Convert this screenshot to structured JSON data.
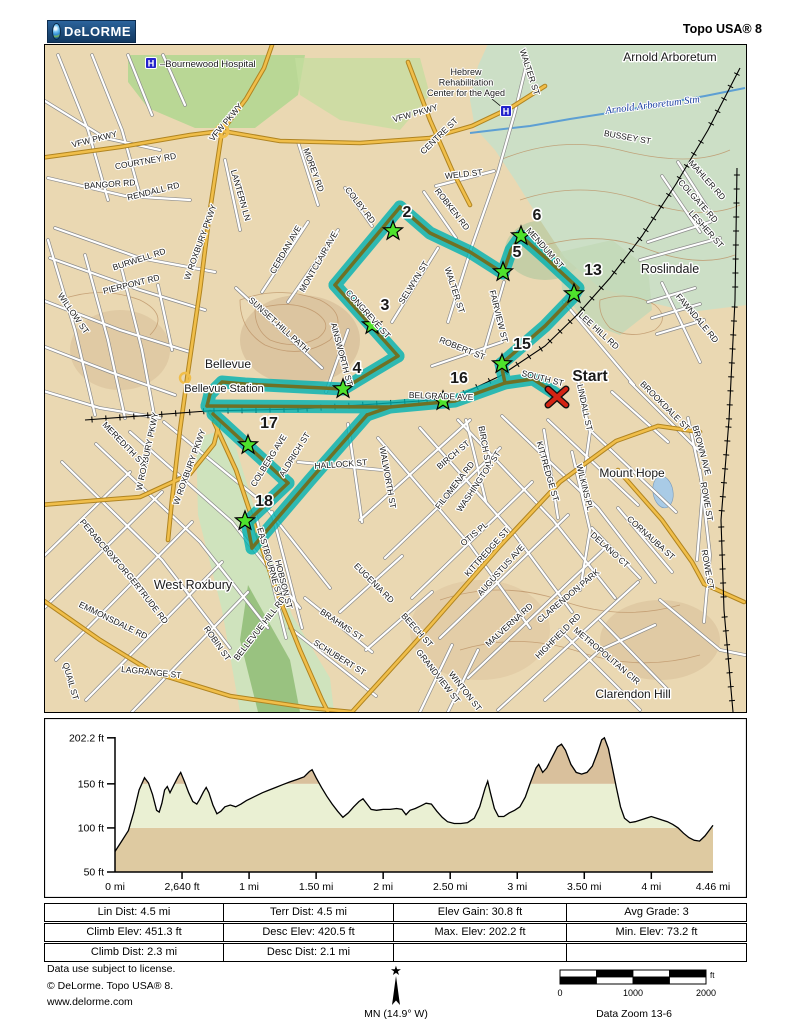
{
  "header": {
    "logo_text": "DeLORME",
    "app_title": "Topo USA® 8"
  },
  "colors": {
    "route_band": "#00b2b2",
    "route_core": "#6f7125",
    "star_green": "#4ee22c",
    "start_red": "#d42413",
    "land": "#ead8b2",
    "park": "#b9d795",
    "arboretum": "#ccdfc6",
    "water": "#5d9fd3",
    "gold_road": "#f0be4a",
    "hospital_blue": "#2323cc",
    "band_low": "#decaa1",
    "band_mid": "#eaf0d3",
    "band_high": "#d9c09c"
  },
  "map": {
    "cities": [
      {
        "t": "Arnold Arboretum",
        "x": 670,
        "y": 61,
        "fs": 12
      },
      {
        "t": "Roslindale",
        "x": 670,
        "y": 273,
        "fs": 12.5
      },
      {
        "t": "Bellevue",
        "x": 228,
        "y": 368,
        "fs": 12
      },
      {
        "t": "Bellevue Station",
        "x": 224,
        "y": 392,
        "fs": 11
      },
      {
        "t": "West Roxbury",
        "x": 193,
        "y": 589,
        "fs": 12.5
      },
      {
        "t": "Mount Hope",
        "x": 632,
        "y": 477,
        "fs": 12
      },
      {
        "t": "Clarendon Hill",
        "x": 633,
        "y": 698,
        "fs": 12
      }
    ],
    "streets": [
      {
        "t": "VFW PKWY",
        "x": 95,
        "y": 142,
        "r": -14
      },
      {
        "t": "VFW PKWY",
        "x": 228,
        "y": 124,
        "r": -50
      },
      {
        "t": "VFW PKWY",
        "x": 416,
        "y": 116,
        "r": -16
      },
      {
        "t": "COURTNEY RD",
        "x": 146,
        "y": 164,
        "r": -10
      },
      {
        "t": "BANGOR RD",
        "x": 110,
        "y": 187,
        "r": -4
      },
      {
        "t": "RENDALL RD",
        "x": 154,
        "y": 194,
        "r": -14
      },
      {
        "t": "LANTERN LN",
        "x": 238,
        "y": 196,
        "r": 74
      },
      {
        "t": "MOREY RD",
        "x": 311,
        "y": 171,
        "r": 70
      },
      {
        "t": "COLBY RD",
        "x": 358,
        "y": 207,
        "r": 52
      },
      {
        "t": "CENTRE ST",
        "x": 441,
        "y": 138,
        "r": -44
      },
      {
        "t": "WALTER ST",
        "x": 527,
        "y": 73,
        "r": 72
      },
      {
        "t": "WELD ST",
        "x": 464,
        "y": 177,
        "r": -6
      },
      {
        "t": "ROBKEN RD",
        "x": 450,
        "y": 211,
        "r": 52
      },
      {
        "t": "BUSSEY ST",
        "x": 627,
        "y": 140,
        "r": 10
      },
      {
        "t": "MAHLER RD",
        "x": 705,
        "y": 182,
        "r": 48
      },
      {
        "t": "COLGATE RD",
        "x": 696,
        "y": 203,
        "r": 48
      },
      {
        "t": "LESHER ST",
        "x": 704,
        "y": 231,
        "r": 48
      },
      {
        "t": "BURWELL RD",
        "x": 140,
        "y": 262,
        "r": -18
      },
      {
        "t": "PIERPONT RD",
        "x": 132,
        "y": 287,
        "r": -14
      },
      {
        "t": "WILLOW ST",
        "x": 71,
        "y": 315,
        "r": 55
      },
      {
        "t": "W ROXBURY PKWY",
        "x": 203,
        "y": 243,
        "r": -70
      },
      {
        "t": "CERDAN AVE",
        "x": 288,
        "y": 251,
        "r": -60
      },
      {
        "t": "MONTCLAIR AVE",
        "x": 321,
        "y": 263,
        "r": -60
      },
      {
        "t": "SELWYN ST",
        "x": 416,
        "y": 284,
        "r": -58
      },
      {
        "t": "CONGREVE ST",
        "x": 366,
        "y": 316,
        "r": 48
      },
      {
        "t": "SUNSET HILL PATH",
        "x": 277,
        "y": 327,
        "r": 42
      },
      {
        "t": "AINSWORTH ST",
        "x": 339,
        "y": 355,
        "r": 75
      },
      {
        "t": "WALTER ST",
        "x": 452,
        "y": 291,
        "r": 72
      },
      {
        "t": "FAIRVIEW ST",
        "x": 496,
        "y": 317,
        "r": 76
      },
      {
        "t": "MENDUM ST",
        "x": 543,
        "y": 250,
        "r": 48
      },
      {
        "t": "ROBERT ST",
        "x": 461,
        "y": 351,
        "r": 22
      },
      {
        "t": "LEE HILL RD",
        "x": 597,
        "y": 333,
        "r": 42
      },
      {
        "t": "SOUTH ST",
        "x": 542,
        "y": 381,
        "r": 14
      },
      {
        "t": "BELGRADE AVE",
        "x": 441,
        "y": 399,
        "r": 2
      },
      {
        "t": "FAWNDALE RD",
        "x": 695,
        "y": 320,
        "r": 50
      },
      {
        "t": "BROOKDALE ST",
        "x": 663,
        "y": 408,
        "r": 45
      },
      {
        "t": "LINDALL ST",
        "x": 582,
        "y": 408,
        "r": 78
      },
      {
        "t": "BROWN AVE",
        "x": 699,
        "y": 451,
        "r": 75
      },
      {
        "t": "WILKINS PL",
        "x": 582,
        "y": 488,
        "r": 76
      },
      {
        "t": "KITTREDGE ST",
        "x": 545,
        "y": 472,
        "r": 74
      },
      {
        "t": "KITTREDGE ST",
        "x": 489,
        "y": 554,
        "r": -48
      },
      {
        "t": "WASHINGTON ST",
        "x": 481,
        "y": 483,
        "r": -56
      },
      {
        "t": "OTIS PL",
        "x": 476,
        "y": 536,
        "r": -40
      },
      {
        "t": "FILOMENA RD",
        "x": 457,
        "y": 487,
        "r": -52
      },
      {
        "t": "BIRCH ST",
        "x": 455,
        "y": 457,
        "r": -40
      },
      {
        "t": "BIRCH ST",
        "x": 482,
        "y": 446,
        "r": 80
      },
      {
        "t": "AUGUSTUS AVE",
        "x": 503,
        "y": 572,
        "r": -48
      },
      {
        "t": "MALVERNA RD",
        "x": 511,
        "y": 627,
        "r": -42
      },
      {
        "t": "CLARENDON PARK",
        "x": 570,
        "y": 598,
        "r": -40
      },
      {
        "t": "HIGHFIELD RD",
        "x": 560,
        "y": 638,
        "r": -45
      },
      {
        "t": "DELANO CT",
        "x": 608,
        "y": 552,
        "r": 42
      },
      {
        "t": "CORNAUBA ST",
        "x": 649,
        "y": 540,
        "r": 42
      },
      {
        "t": "ROWE ST",
        "x": 704,
        "y": 502,
        "r": 80
      },
      {
        "t": "ROWE CT",
        "x": 705,
        "y": 570,
        "r": 80
      },
      {
        "t": "METROPOLITAN CIR",
        "x": 605,
        "y": 658,
        "r": 40
      },
      {
        "t": "W ROXBURY PKWY",
        "x": 150,
        "y": 452,
        "r": -78
      },
      {
        "t": "W ROXBURY PKWY",
        "x": 192,
        "y": 468,
        "r": -70
      },
      {
        "t": "MEREDITH ST",
        "x": 122,
        "y": 446,
        "r": 46
      },
      {
        "t": "PERABO TER",
        "x": 97,
        "y": 543,
        "r": 50
      },
      {
        "t": "BOXFORD-TER",
        "x": 122,
        "y": 572,
        "r": 50
      },
      {
        "t": "GERTRUDE RD",
        "x": 145,
        "y": 600,
        "r": 52
      },
      {
        "t": "EMMONSDALE RD",
        "x": 112,
        "y": 623,
        "r": 26
      },
      {
        "t": "QUAIL ST",
        "x": 68,
        "y": 682,
        "r": 74
      },
      {
        "t": "LAGRANGE ST",
        "x": 151,
        "y": 675,
        "r": 6
      },
      {
        "t": "ROBIN ST",
        "x": 215,
        "y": 645,
        "r": 55
      },
      {
        "t": "BELLEVUE HILL RD",
        "x": 262,
        "y": 630,
        "r": -52
      },
      {
        "t": "EASTBOURNE ST",
        "x": 267,
        "y": 563,
        "r": 74
      },
      {
        "t": "HOBSON ST",
        "x": 281,
        "y": 585,
        "r": 76
      },
      {
        "t": "BRAHMS ST",
        "x": 340,
        "y": 627,
        "r": 34
      },
      {
        "t": "SCHUBERT ST",
        "x": 338,
        "y": 660,
        "r": 32
      },
      {
        "t": "EUGENIA RD",
        "x": 372,
        "y": 585,
        "r": 45
      },
      {
        "t": "BEECH ST",
        "x": 415,
        "y": 632,
        "r": 48
      },
      {
        "t": "GRANDVIEW ST",
        "x": 436,
        "y": 678,
        "r": 52
      },
      {
        "t": "WINTON ST",
        "x": 463,
        "y": 693,
        "r": 52
      },
      {
        "t": "WALWORTH ST",
        "x": 385,
        "y": 478,
        "r": 80
      },
      {
        "t": "HALLOCK ST",
        "x": 341,
        "y": 467,
        "r": -4
      },
      {
        "t": "COLBERG AVE",
        "x": 271,
        "y": 462,
        "r": -58
      },
      {
        "t": "ALDRICH ST",
        "x": 297,
        "y": 456,
        "r": -58
      }
    ],
    "water_label": {
      "t": "Arnold Arboretum Stm",
      "x": 653,
      "y": 108,
      "r": -7
    },
    "hospital1": {
      "icon_x": 151,
      "icon_y": 63,
      "t": "–Bournewood Hospital",
      "tx": 160,
      "ty": 67
    },
    "hospital2": {
      "icon_x": 506,
      "icon_y": 111,
      "lines": [
        "Hebrew",
        "Rehabilitation",
        "Center for the Aged"
      ],
      "lx": 466,
      "ly": 75
    },
    "waypoints": [
      {
        "n": "2",
        "sx": 393,
        "sy": 231,
        "lx": 407,
        "ly": 217
      },
      {
        "n": "3",
        "sx": 372,
        "sy": 325,
        "lx": 385,
        "ly": 310
      },
      {
        "n": "4",
        "sx": 343,
        "sy": 389,
        "lx": 357,
        "ly": 373
      },
      {
        "n": "5",
        "sx": 503,
        "sy": 272,
        "lx": 517,
        "ly": 257
      },
      {
        "n": "6",
        "sx": 521,
        "sy": 236,
        "lx": 537,
        "ly": 220
      },
      {
        "n": "13",
        "sx": 574,
        "sy": 294,
        "lx": 593,
        "ly": 275
      },
      {
        "n": "15",
        "sx": 502,
        "sy": 364,
        "lx": 522,
        "ly": 349
      },
      {
        "n": "16",
        "sx": 443,
        "sy": 401,
        "lx": 459,
        "ly": 383
      },
      {
        "n": "17",
        "sx": 248,
        "sy": 445,
        "lx": 269,
        "ly": 428
      },
      {
        "n": "18",
        "sx": 245,
        "sy": 521,
        "lx": 264,
        "ly": 506
      }
    ],
    "start": {
      "t": "Start",
      "x": 557,
      "y": 397,
      "lx": 590,
      "ly": 381
    }
  },
  "chart_data": {
    "type": "area",
    "title": "Elevation profile",
    "ylabel": "elevation (ft)",
    "xlabel": "distance (mi)",
    "xlim": [
      0,
      4.46
    ],
    "ylim": [
      50,
      202.2
    ],
    "y_ticks": [
      {
        "v": 202.2,
        "label": "202.2 ft"
      },
      {
        "v": 150,
        "label": "150 ft"
      },
      {
        "v": 100,
        "label": "100 ft"
      },
      {
        "v": 50,
        "label": "50 ft"
      }
    ],
    "x_ticks": [
      {
        "v": 0,
        "label": "0 mi"
      },
      {
        "v": 0.5,
        "label": "2,640 ft"
      },
      {
        "v": 1,
        "label": "1 mi"
      },
      {
        "v": 1.5,
        "label": "1.50 mi"
      },
      {
        "v": 2,
        "label": "2 mi"
      },
      {
        "v": 2.5,
        "label": "2.50 mi"
      },
      {
        "v": 3,
        "label": "3 mi"
      },
      {
        "v": 3.5,
        "label": "3.50 mi"
      },
      {
        "v": 4,
        "label": "4 mi"
      },
      {
        "v": 4.46,
        "label": "4.46 mi"
      }
    ],
    "bands": [
      {
        "from": 50,
        "to": 100
      },
      {
        "from": 100,
        "to": 150
      },
      {
        "from": 150,
        "to": 202.2
      }
    ],
    "profile": [
      [
        0,
        73.2
      ],
      [
        0.05,
        85
      ],
      [
        0.1,
        97
      ],
      [
        0.14,
        118
      ],
      [
        0.18,
        143
      ],
      [
        0.22,
        157
      ],
      [
        0.25,
        151
      ],
      [
        0.28,
        138
      ],
      [
        0.31,
        120
      ],
      [
        0.33,
        118
      ],
      [
        0.35,
        128
      ],
      [
        0.37,
        143
      ],
      [
        0.39,
        147
      ],
      [
        0.41,
        140
      ],
      [
        0.44,
        149
      ],
      [
        0.47,
        158
      ],
      [
        0.49,
        163
      ],
      [
        0.52,
        152
      ],
      [
        0.55,
        140
      ],
      [
        0.58,
        130
      ],
      [
        0.61,
        127
      ],
      [
        0.63,
        132
      ],
      [
        0.66,
        141
      ],
      [
        0.68,
        146
      ],
      [
        0.7,
        140
      ],
      [
        0.73,
        126
      ],
      [
        0.76,
        116
      ],
      [
        0.79,
        119
      ],
      [
        0.82,
        124
      ],
      [
        0.86,
        126
      ],
      [
        0.9,
        124
      ],
      [
        0.94,
        127
      ],
      [
        0.98,
        131
      ],
      [
        1.02,
        134
      ],
      [
        1.06,
        137
      ],
      [
        1.1,
        140
      ],
      [
        1.15,
        143
      ],
      [
        1.2,
        146
      ],
      [
        1.25,
        149
      ],
      [
        1.3,
        152
      ],
      [
        1.36,
        155
      ],
      [
        1.41,
        158
      ],
      [
        1.45,
        164
      ],
      [
        1.47,
        166
      ],
      [
        1.5,
        157
      ],
      [
        1.54,
        146
      ],
      [
        1.58,
        136
      ],
      [
        1.62,
        127
      ],
      [
        1.66,
        119
      ],
      [
        1.7,
        112
      ],
      [
        1.74,
        117
      ],
      [
        1.78,
        124
      ],
      [
        1.82,
        130
      ],
      [
        1.85,
        133
      ],
      [
        1.88,
        127
      ],
      [
        1.91,
        121
      ],
      [
        1.95,
        120
      ],
      [
        2.0,
        121
      ],
      [
        2.05,
        121
      ],
      [
        2.1,
        122
      ],
      [
        2.14,
        121
      ],
      [
        2.17,
        115
      ],
      [
        2.2,
        120
      ],
      [
        2.24,
        122
      ],
      [
        2.28,
        125
      ],
      [
        2.32,
        128
      ],
      [
        2.36,
        127
      ],
      [
        2.4,
        119
      ],
      [
        2.44,
        112
      ],
      [
        2.48,
        107
      ],
      [
        2.53,
        105
      ],
      [
        2.58,
        105
      ],
      [
        2.63,
        106
      ],
      [
        2.68,
        111
      ],
      [
        2.72,
        124
      ],
      [
        2.76,
        145
      ],
      [
        2.78,
        153
      ],
      [
        2.8,
        140
      ],
      [
        2.83,
        122
      ],
      [
        2.86,
        113
      ],
      [
        2.9,
        113
      ],
      [
        2.94,
        117
      ],
      [
        2.98,
        120
      ],
      [
        3.02,
        124
      ],
      [
        3.06,
        135
      ],
      [
        3.1,
        152
      ],
      [
        3.14,
        168
      ],
      [
        3.16,
        172
      ],
      [
        3.19,
        163
      ],
      [
        3.22,
        168
      ],
      [
        3.26,
        180
      ],
      [
        3.3,
        192
      ],
      [
        3.33,
        195
      ],
      [
        3.36,
        188
      ],
      [
        3.4,
        172
      ],
      [
        3.44,
        163
      ],
      [
        3.48,
        161
      ],
      [
        3.52,
        163
      ],
      [
        3.56,
        170
      ],
      [
        3.6,
        186
      ],
      [
        3.63,
        200
      ],
      [
        3.65,
        202.2
      ],
      [
        3.68,
        190
      ],
      [
        3.71,
        168
      ],
      [
        3.74,
        145
      ],
      [
        3.77,
        124
      ],
      [
        3.8,
        111
      ],
      [
        3.84,
        106
      ],
      [
        3.88,
        107
      ],
      [
        3.92,
        109
      ],
      [
        3.96,
        111
      ],
      [
        4.0,
        113
      ],
      [
        4.04,
        111
      ],
      [
        4.08,
        109
      ],
      [
        4.12,
        107
      ],
      [
        4.16,
        104
      ],
      [
        4.2,
        100
      ],
      [
        4.24,
        94
      ],
      [
        4.28,
        89
      ],
      [
        4.32,
        86
      ],
      [
        4.36,
        85
      ],
      [
        4.4,
        91
      ],
      [
        4.43,
        97
      ],
      [
        4.46,
        103
      ]
    ]
  },
  "stats": {
    "rows": [
      [
        "Lin Dist:  4.5 mi",
        "Terr Dist:  4.5 mi",
        "Elev Gain:  30.8 ft",
        "Avg Grade:  3"
      ],
      [
        "Climb Elev:  451.3 ft",
        "Desc Elev:  420.5 ft",
        "Max. Elev:  202.2 ft",
        "Min. Elev:  73.2 ft"
      ],
      [
        "Climb Dist:  2.3 mi",
        "Desc Dist:  2.1 mi",
        "",
        ""
      ]
    ]
  },
  "footer": {
    "license_lines": [
      "Data use subject to license.",
      "© DeLorme. Topo USA® 8.",
      "www.delorme.com"
    ],
    "compass_label": "MN (14.9° W)",
    "scale_labels": [
      "0",
      "1000",
      "2000"
    ],
    "scale_unit": "ft",
    "data_zoom": "Data Zoom 13-6"
  }
}
